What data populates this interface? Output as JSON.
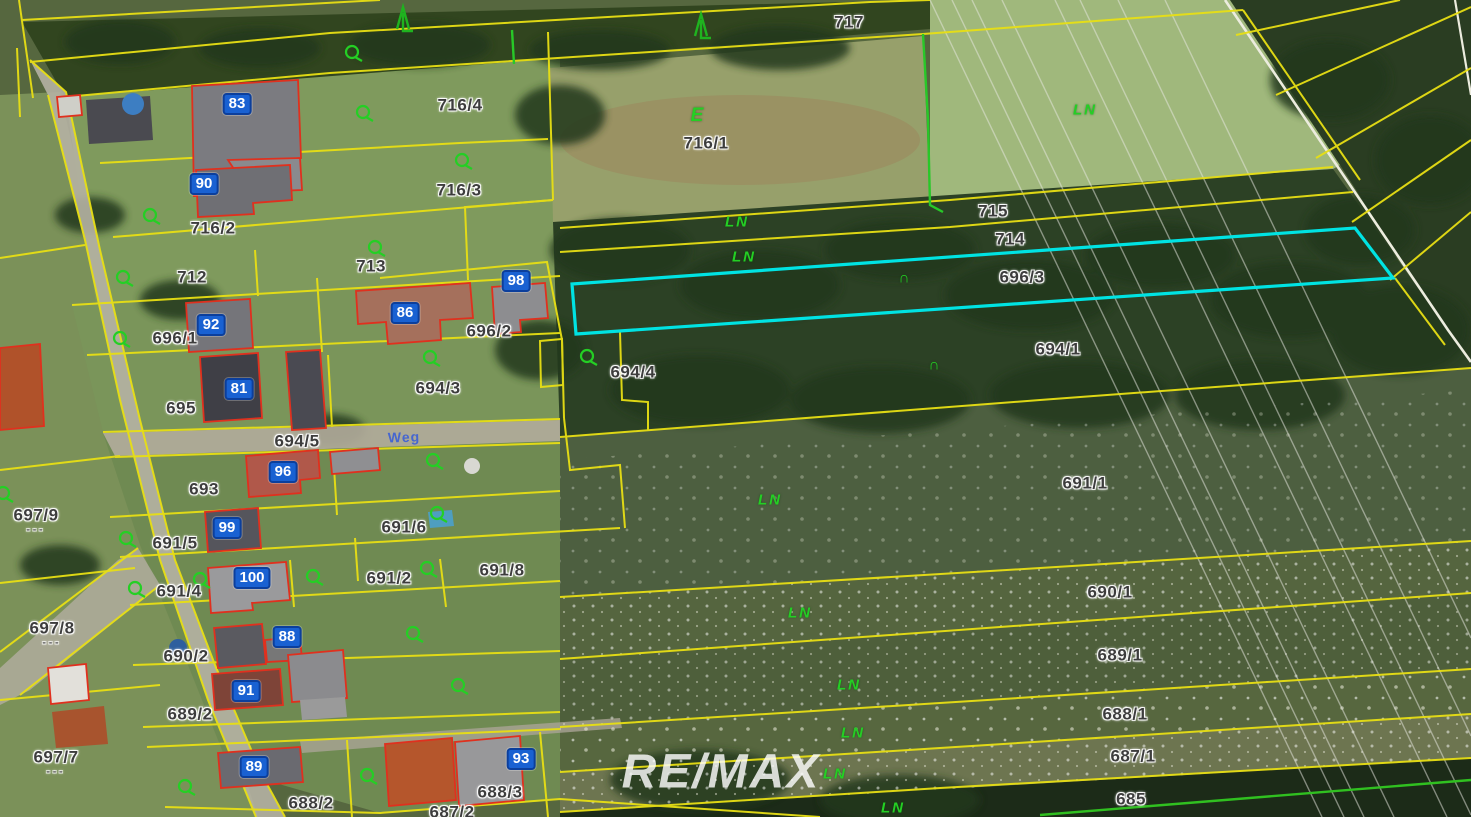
{
  "map": {
    "watermark": "RE/MAX",
    "road_name": {
      "text": "Weg",
      "x": 404,
      "y": 437
    },
    "colors": {
      "parcel_line": "#e8df14",
      "highlight": "#00e3e3",
      "building_outline": "#e0301e",
      "usage_green": "#24cf24",
      "badge_blue": "#1961d2",
      "label_gray": "#3d3d3d"
    },
    "highlighted_parcel": {
      "number": "696/3",
      "points": "572,284 1355,228 1393,278 576,334"
    },
    "parcel_labels": [
      {
        "text": "717",
        "x": 849,
        "y": 22
      },
      {
        "text": "716/4",
        "x": 460,
        "y": 105
      },
      {
        "text": "716/1",
        "x": 706,
        "y": 143
      },
      {
        "text": "716/3",
        "x": 459,
        "y": 190
      },
      {
        "text": "716/2",
        "x": 213,
        "y": 228
      },
      {
        "text": "712",
        "x": 192,
        "y": 277
      },
      {
        "text": "713",
        "x": 371,
        "y": 266
      },
      {
        "text": "715",
        "x": 993,
        "y": 211
      },
      {
        "text": "714",
        "x": 1010,
        "y": 239
      },
      {
        "text": "696/3",
        "x": 1022,
        "y": 277
      },
      {
        "text": "696/1",
        "x": 175,
        "y": 338
      },
      {
        "text": "696/2",
        "x": 489,
        "y": 331
      },
      {
        "text": "694/4",
        "x": 633,
        "y": 372
      },
      {
        "text": "694/1",
        "x": 1058,
        "y": 349
      },
      {
        "text": "695",
        "x": 181,
        "y": 408
      },
      {
        "text": "694/3",
        "x": 438,
        "y": 388
      },
      {
        "text": "694/5",
        "x": 297,
        "y": 441
      },
      {
        "text": "693",
        "x": 204,
        "y": 489
      },
      {
        "text": "697/9",
        "x": 36,
        "y": 521,
        "dashes": true
      },
      {
        "text": "691/5",
        "x": 175,
        "y": 543
      },
      {
        "text": "691/6",
        "x": 404,
        "y": 527
      },
      {
        "text": "691/4",
        "x": 179,
        "y": 591
      },
      {
        "text": "691/2",
        "x": 389,
        "y": 578
      },
      {
        "text": "691/8",
        "x": 502,
        "y": 570
      },
      {
        "text": "691/1",
        "x": 1085,
        "y": 483
      },
      {
        "text": "690/1",
        "x": 1110,
        "y": 592
      },
      {
        "text": "697/8",
        "x": 52,
        "y": 634,
        "dashes": true
      },
      {
        "text": "690/2",
        "x": 186,
        "y": 656
      },
      {
        "text": "689/1",
        "x": 1120,
        "y": 655
      },
      {
        "text": "689/2",
        "x": 190,
        "y": 714
      },
      {
        "text": "688/1",
        "x": 1125,
        "y": 714
      },
      {
        "text": "697/7",
        "x": 56,
        "y": 763,
        "dashes": true
      },
      {
        "text": "687/1",
        "x": 1133,
        "y": 756
      },
      {
        "text": "688/2",
        "x": 311,
        "y": 803
      },
      {
        "text": "688/3",
        "x": 500,
        "y": 792
      },
      {
        "text": "687/2",
        "x": 452,
        "y": 812
      },
      {
        "text": "685",
        "x": 1131,
        "y": 799
      }
    ],
    "house_numbers": [
      {
        "text": "83",
        "x": 237,
        "y": 104
      },
      {
        "text": "90",
        "x": 204,
        "y": 184
      },
      {
        "text": "98",
        "x": 516,
        "y": 281
      },
      {
        "text": "92",
        "x": 211,
        "y": 325
      },
      {
        "text": "86",
        "x": 405,
        "y": 313
      },
      {
        "text": "81",
        "x": 239,
        "y": 389
      },
      {
        "text": "96",
        "x": 283,
        "y": 472
      },
      {
        "text": "99",
        "x": 227,
        "y": 528
      },
      {
        "text": "100",
        "x": 252,
        "y": 578
      },
      {
        "text": "88",
        "x": 287,
        "y": 637
      },
      {
        "text": "91",
        "x": 246,
        "y": 691
      },
      {
        "text": "89",
        "x": 254,
        "y": 767
      },
      {
        "text": "93",
        "x": 521,
        "y": 759
      }
    ],
    "usage_labels": [
      {
        "text": "E",
        "x": 698,
        "y": 116,
        "big": true
      },
      {
        "text": "LN",
        "x": 1085,
        "y": 110
      },
      {
        "text": "LN",
        "x": 737,
        "y": 222
      },
      {
        "text": "LN",
        "x": 744,
        "y": 257
      },
      {
        "text": "LN",
        "x": 770,
        "y": 500
      },
      {
        "text": "LN",
        "x": 800,
        "y": 613
      },
      {
        "text": "LN",
        "x": 849,
        "y": 685
      },
      {
        "text": "LN",
        "x": 853,
        "y": 733
      },
      {
        "text": "LN",
        "x": 835,
        "y": 774
      },
      {
        "text": "LN",
        "x": 893,
        "y": 808
      },
      {
        "text": "∩",
        "x": 905,
        "y": 278
      },
      {
        "text": "∩",
        "x": 935,
        "y": 365
      }
    ],
    "symbols": [
      {
        "type": "grassland",
        "x": 352,
        "y": 52
      },
      {
        "type": "grassland",
        "x": 363,
        "y": 112
      },
      {
        "type": "grassland",
        "x": 150,
        "y": 215
      },
      {
        "type": "grassland",
        "x": 462,
        "y": 160
      },
      {
        "type": "grassland",
        "x": 375,
        "y": 247
      },
      {
        "type": "grassland",
        "x": 123,
        "y": 277
      },
      {
        "type": "grassland",
        "x": 120,
        "y": 338
      },
      {
        "type": "grassland",
        "x": 430,
        "y": 357
      },
      {
        "type": "grassland",
        "x": 587,
        "y": 356
      },
      {
        "type": "grassland",
        "x": 3,
        "y": 493
      },
      {
        "type": "grassland",
        "x": 433,
        "y": 460
      },
      {
        "type": "grassland",
        "x": 437,
        "y": 513
      },
      {
        "type": "grassland",
        "x": 126,
        "y": 538
      },
      {
        "type": "grassland",
        "x": 200,
        "y": 579
      },
      {
        "type": "grassland",
        "x": 135,
        "y": 588
      },
      {
        "type": "grassland",
        "x": 313,
        "y": 576
      },
      {
        "type": "grassland",
        "x": 427,
        "y": 568
      },
      {
        "type": "grassland",
        "x": 413,
        "y": 633
      },
      {
        "type": "grassland",
        "x": 458,
        "y": 685
      },
      {
        "type": "grassland",
        "x": 185,
        "y": 786
      },
      {
        "type": "grassland",
        "x": 367,
        "y": 775
      },
      {
        "type": "conifer",
        "x": 397,
        "y": 15
      },
      {
        "type": "conifer",
        "x": 695,
        "y": 22
      }
    ]
  }
}
